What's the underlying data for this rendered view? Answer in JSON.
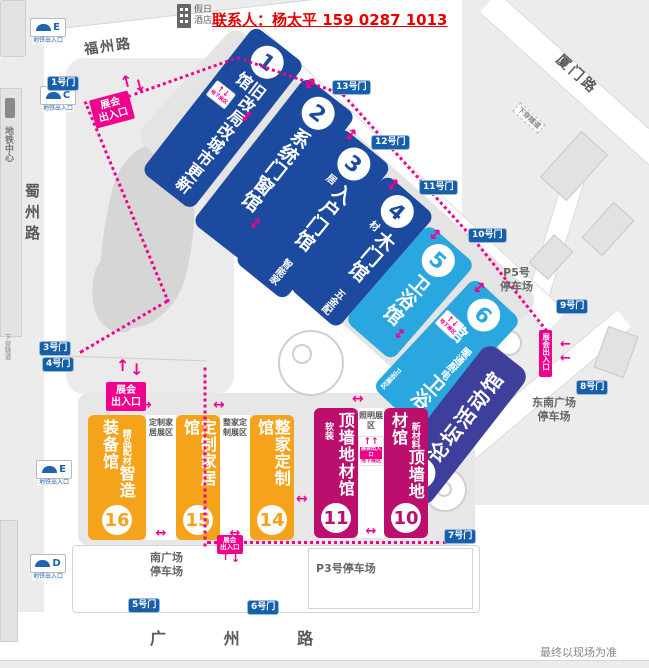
{
  "colors": {
    "dark_blue": "#1c4a9e",
    "light_blue": "#2aa7df",
    "indigo": "#3d3f9b",
    "orange": "#f6a31c",
    "magenta": "#bb0e6d",
    "pink": "#f0008c",
    "gate_blue": "#1660ab",
    "contact_red": "#e60000"
  },
  "header": {
    "hotel_name_line1": "假日",
    "hotel_name_line2": "酒店",
    "contact": "联系人：杨太平 159 0287 1013"
  },
  "footer": {
    "disclaimer": "最终以现场为准"
  },
  "streets": {
    "fuzhou": "福州路",
    "xiamen": "厦门路",
    "shuzhou": "蜀州路",
    "guangzhou": "广 州 路",
    "underpass_right": "下穿隧道",
    "underpass_left": "下穿隧道"
  },
  "metro": {
    "caption": "地铁出入口",
    "center": "地铁中心",
    "exit_e_top": "E",
    "exit_c": "C",
    "exit_e_mid": "E",
    "exit_d": "D"
  },
  "gates": {
    "g1": "1号门",
    "g3": "3号门",
    "g4": "4号门",
    "g5": "5号门",
    "g6": "6号门",
    "g7": "7号门",
    "g8": "8号门",
    "g9": "9号门",
    "g10": "10号门",
    "g11": "11号门",
    "g12": "12号门",
    "g13": "13号门"
  },
  "parking": {
    "p5_line1": "P5号",
    "p5_line2": "停车场",
    "se_line1": "东南广场",
    "se_line2": "停车场",
    "south_line1": "南广场",
    "south_line2": "停车场",
    "p3": "P3号停车场"
  },
  "entrance": {
    "line1": "展会",
    "line2": "出入口",
    "vertical": "展会出入口"
  },
  "underground": {
    "title": "展会出入口",
    "area": "地下展区"
  },
  "halls": {
    "h1": {
      "num": "1",
      "col_right": "旧改局改",
      "col_left": "城市更新馆"
    },
    "h2": {
      "num": "2",
      "name": "系统门窗馆"
    },
    "h3": {
      "num": "3",
      "name": "入户门馆",
      "sub": "智能家居"
    },
    "h4": {
      "num": "4",
      "name": "木门馆",
      "sub": "五金配材"
    },
    "h5": {
      "num": "5",
      "name": "卫浴馆"
    },
    "h6": {
      "num": "6",
      "name": "卫浴馆",
      "sub": "暖通厨电",
      "corner": "卫浴展区"
    },
    "h9": {
      "num": "9",
      "name": "论坛活动馆"
    },
    "h10": {
      "num": "10",
      "name": "顶墙地材馆",
      "sub": "新材料"
    },
    "h11": {
      "num": "11",
      "name": "顶墙地材馆",
      "sub": "软装"
    },
    "h14": {
      "num": "14",
      "name": "整家定制馆"
    },
    "h15": {
      "num": "15",
      "name": "定制家居馆"
    },
    "h16": {
      "num": "16",
      "name": "智造装备馆",
      "sub": "精品配材"
    }
  },
  "zones": {
    "z1": "定制家居展区",
    "z2": "整家定制展区",
    "z3": "照明展区"
  }
}
